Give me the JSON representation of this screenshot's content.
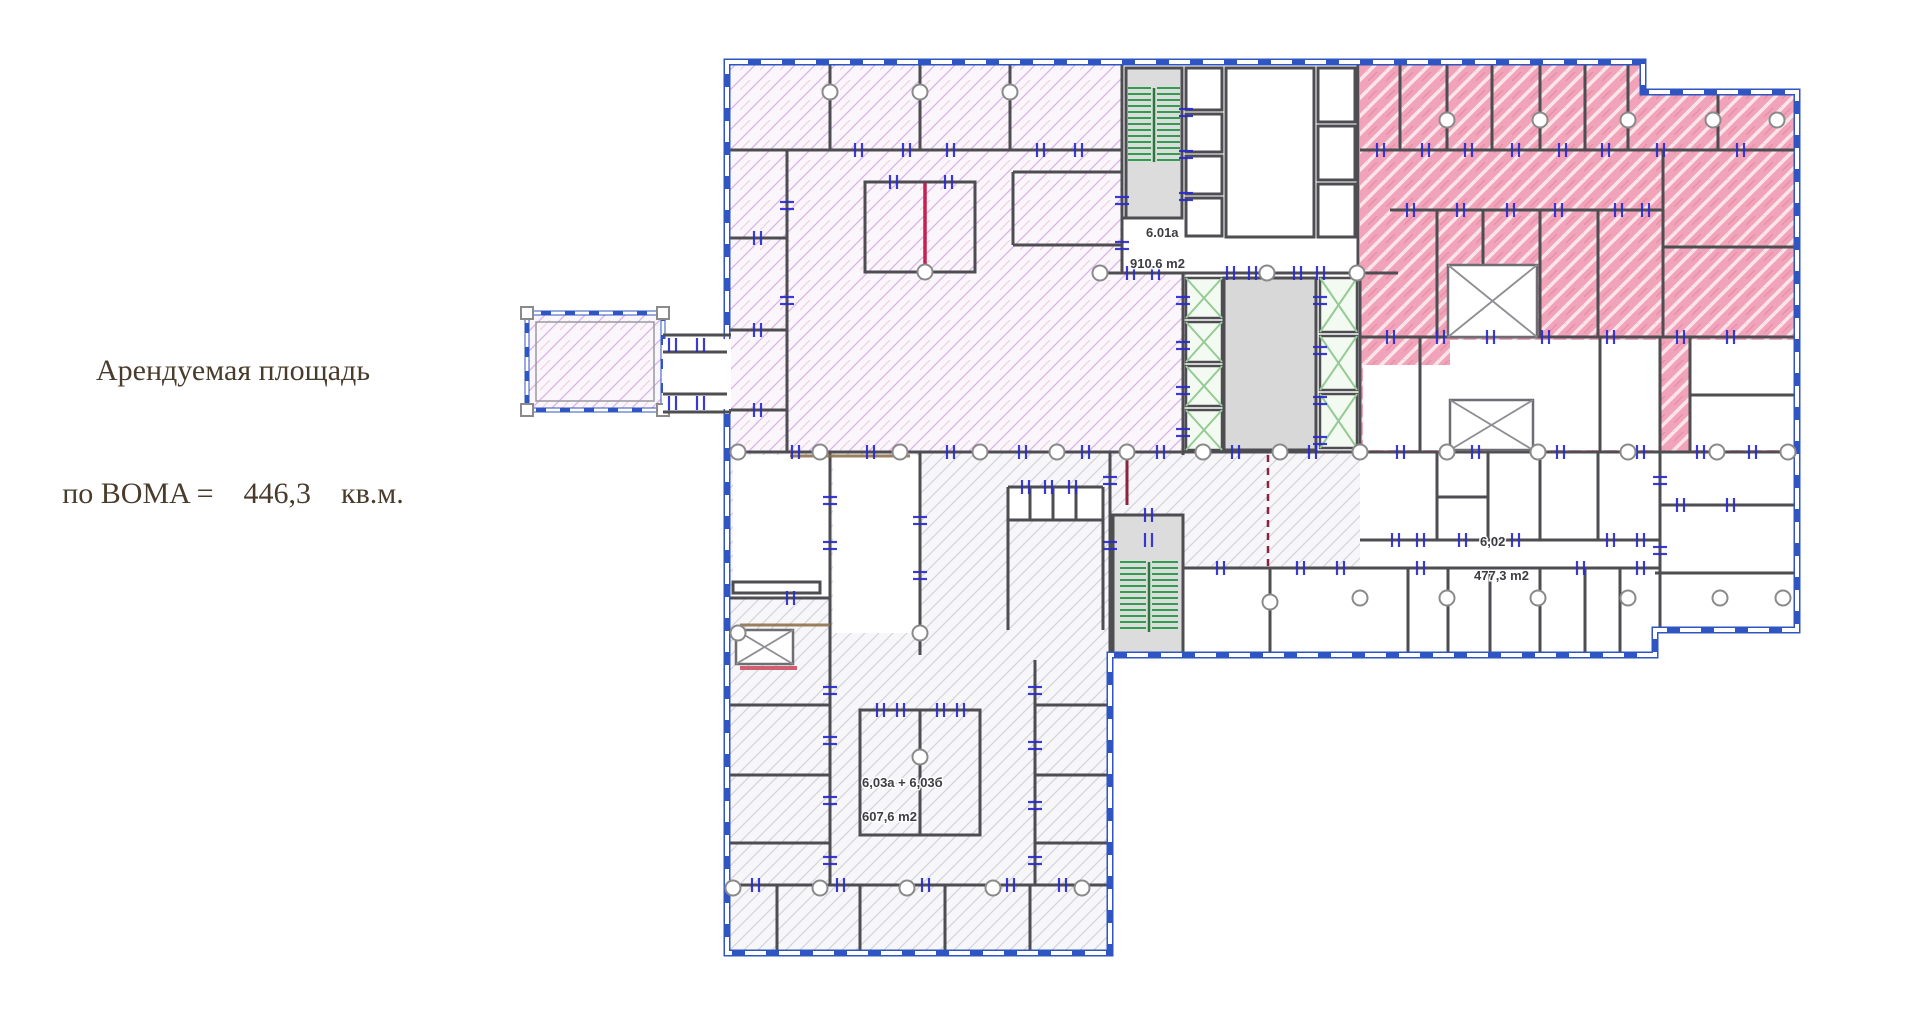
{
  "annotation": {
    "line1": "Арендуемая площадь",
    "line2": "по BOMA =    446,3    кв.м."
  },
  "plan_labels": [
    {
      "name": "label-room-6-01a",
      "text": "6.01a",
      "x": 1146,
      "y": 237
    },
    {
      "name": "label-area-910-6",
      "text": "910.6 m2",
      "x": 1130,
      "y": 268
    },
    {
      "name": "label-room-6-02",
      "text": "6,02",
      "x": 1480,
      "y": 546
    },
    {
      "name": "label-area-477-3",
      "text": "477,3 m2",
      "x": 1474,
      "y": 580
    },
    {
      "name": "label-room-6-03",
      "text": "6,03a + 6,03б",
      "x": 862,
      "y": 787
    },
    {
      "name": "label-area-607-6",
      "text": "607,6 m2",
      "x": 862,
      "y": 821
    }
  ],
  "colors": {
    "text_brown": "#4a3c2c",
    "exterior_blue": "#2f55c2",
    "wall_gray": "#4d4d52",
    "door_blue": "#2b2bd0",
    "stair_green": "#2f9e4f",
    "elevator_green": "#95cb95",
    "accent_red": "#c42050",
    "dark_red": "#8e2040",
    "tan": "#8a6b42",
    "lilac_hatch": "#d9b4e6",
    "pink_hatch": "#f1a4b9",
    "gray_hatch": "#d3d3db"
  }
}
